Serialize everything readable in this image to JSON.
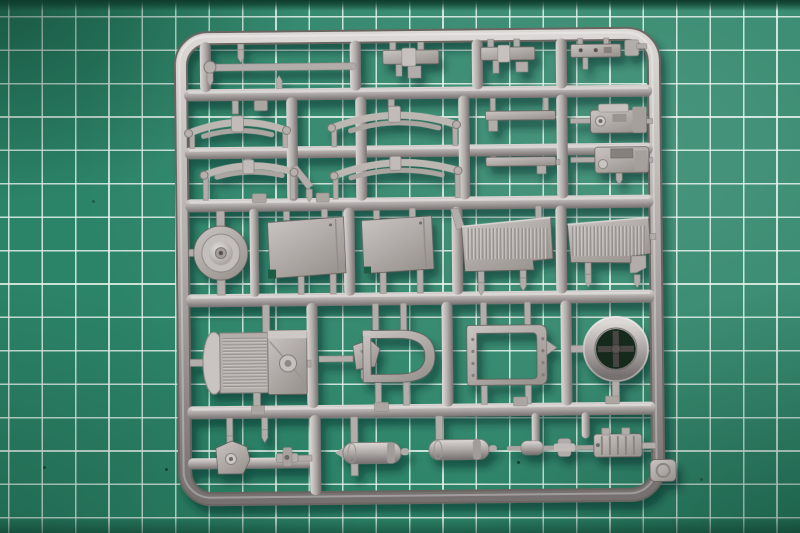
{
  "scene": {
    "type": "photograph",
    "subject": "grey styrene model-kit sprue (parts runner) lying on a green self-healing cutting mat",
    "view": "top-down"
  },
  "palette": {
    "mat_base": "#2c8468",
    "mat_light": "#42a185",
    "mat_dark": "#1c6a50",
    "mat_top_edge": "#0e3c2c",
    "grid_line": "rgba(228,242,235,0.85)",
    "plastic_base": "#b2acaa",
    "plastic_light": "#dcd8d6",
    "plastic_dark": "#767070",
    "plastic_outline": "#5f5a57",
    "hole_dark": "#14291f",
    "spoke_dark": "#4a4542",
    "shadow_color": "#06231a"
  },
  "mat": {
    "grid_spacing_px": 33.4,
    "grid_line_width_px": 1.6,
    "grid_offset_x_px": 8,
    "grid_offset_y_px": 16
  },
  "sprue": {
    "material": "silver-grey styrene plastic",
    "parts": [
      {
        "id": "sprue-frame",
        "label": "outer rounded runner frame"
      },
      {
        "id": "tie-rod",
        "label": "tie rod with ball joint"
      },
      {
        "id": "flat-bar-a",
        "label": "flat bar part"
      },
      {
        "id": "flat-bar-b",
        "label": "flat bar part"
      },
      {
        "id": "drilled-bar",
        "label": "flat bar with drilled holes"
      },
      {
        "id": "leaf-spring-1",
        "label": "curved leaf spring"
      },
      {
        "id": "leaf-spring-2",
        "label": "curved leaf spring"
      },
      {
        "id": "leaf-spring-3",
        "label": "flat leaf spring"
      },
      {
        "id": "leaf-spring-4",
        "label": "flat leaf spring"
      },
      {
        "id": "mounting-strip-a",
        "label": "thin mounting strip"
      },
      {
        "id": "mounting-strip-b",
        "label": "thin mounting strip"
      },
      {
        "id": "transfer-case-a",
        "label": "gearbox / transfer case"
      },
      {
        "id": "transfer-case-b",
        "label": "gearbox / transfer case"
      },
      {
        "id": "wheel-hub",
        "label": "wheel hub drum"
      },
      {
        "id": "door-panel-a",
        "label": "flat door panel"
      },
      {
        "id": "door-panel-b",
        "label": "flat door panel"
      },
      {
        "id": "louver-panel-a",
        "label": "louvered engine panel"
      },
      {
        "id": "louver-panel-b",
        "label": "louvered engine panel"
      },
      {
        "id": "radiator",
        "label": "radiator with finned core"
      },
      {
        "id": "steering-bracket",
        "label": "pentagonal bracket"
      },
      {
        "id": "cab-frame",
        "label": "rounded open cab frame"
      },
      {
        "id": "riveted-frame",
        "label": "riveted open door frame"
      },
      {
        "id": "wheel-rim",
        "label": "spare wheel rim ring"
      },
      {
        "id": "axle-bracket",
        "label": "axle mount bracket"
      },
      {
        "id": "hinge-fitting",
        "label": "small hinge fitting"
      },
      {
        "id": "muffler-a",
        "label": "exhaust muffler cylinder"
      },
      {
        "id": "muffler-b",
        "label": "exhaust muffler cylinder"
      },
      {
        "id": "drive-shaft",
        "label": "drive shaft assembly"
      },
      {
        "id": "ribbed-block",
        "label": "ribbed gearbox block"
      },
      {
        "id": "corner-plate",
        "label": "corner number plate"
      }
    ]
  }
}
